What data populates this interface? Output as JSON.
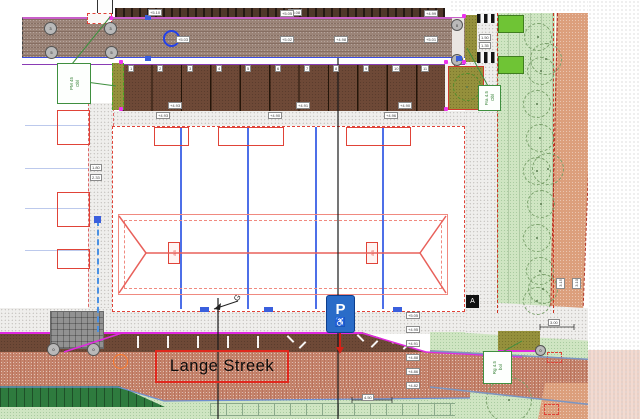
{
  "street": {
    "label": "Lange Streek"
  },
  "parking_sign": {
    "letter": "P",
    "wheelchair": "♿"
  },
  "markers": {
    "g": "G",
    "a": "A"
  },
  "plant_labels": {
    "p1": {
      "line1": "PM 45",
      "line2": "Obl"
    },
    "p2": {
      "line1": "Fra 4.5",
      "line2": "Obl"
    },
    "p3": {
      "line1": "Rg 4.5",
      "line2": "bol"
    }
  },
  "dimensions": {
    "d1": "1.80",
    "d2": "2.33",
    "d3": "1.50",
    "d4": "1.35",
    "d5": "3.00",
    "d6": "4.50",
    "d7": "3.15",
    "d8": "3.10"
  },
  "levels": {
    "band": [
      "+5.10",
      "+5.08"
    ],
    "road": [
      "+5.03",
      "+5.02",
      "+4.98",
      "+5.05",
      "+5.01",
      "+4.99"
    ],
    "sidewalk_top": [
      "+4.93",
      "+4.90",
      "+4.96"
    ],
    "stall_bottom": [
      "+4.93",
      "+4.91",
      "+4.90"
    ],
    "column": [
      "+5.05",
      "+4.95",
      "+4.91",
      "+4.88",
      "+4.86",
      "+4.82"
    ]
  },
  "stalls": {
    "numbers": [
      "1",
      "2",
      "3",
      "4",
      "5",
      "6",
      "7",
      "8",
      "9",
      "10",
      "11"
    ]
  },
  "ridge_labels": {
    "left": "8.5",
    "right": "8.5"
  },
  "manholes": {
    "m1": "3",
    "m2": "3",
    "m3": "5",
    "m4": "5",
    "m5": "0",
    "m6": "0",
    "m7": "0",
    "m8": "0",
    "m9": "0"
  },
  "colors": {
    "road_top_brick": "#9b8478",
    "road_red_brick": "#c4836b",
    "stall_brown": "#6e4937",
    "dark_band": "#4f382a",
    "sidewalk": "#efeeec",
    "grass": "#cfe5c2",
    "hedge_green": "#6fc435",
    "olive": "#95903c",
    "salmon": "#dc9f7c",
    "dark_green": "#2e7b3e",
    "magenta": "#e02ae0",
    "blue_line": "#4d6fe8",
    "red_line": "#e04338",
    "sign_blue": "#2a6cc8"
  }
}
